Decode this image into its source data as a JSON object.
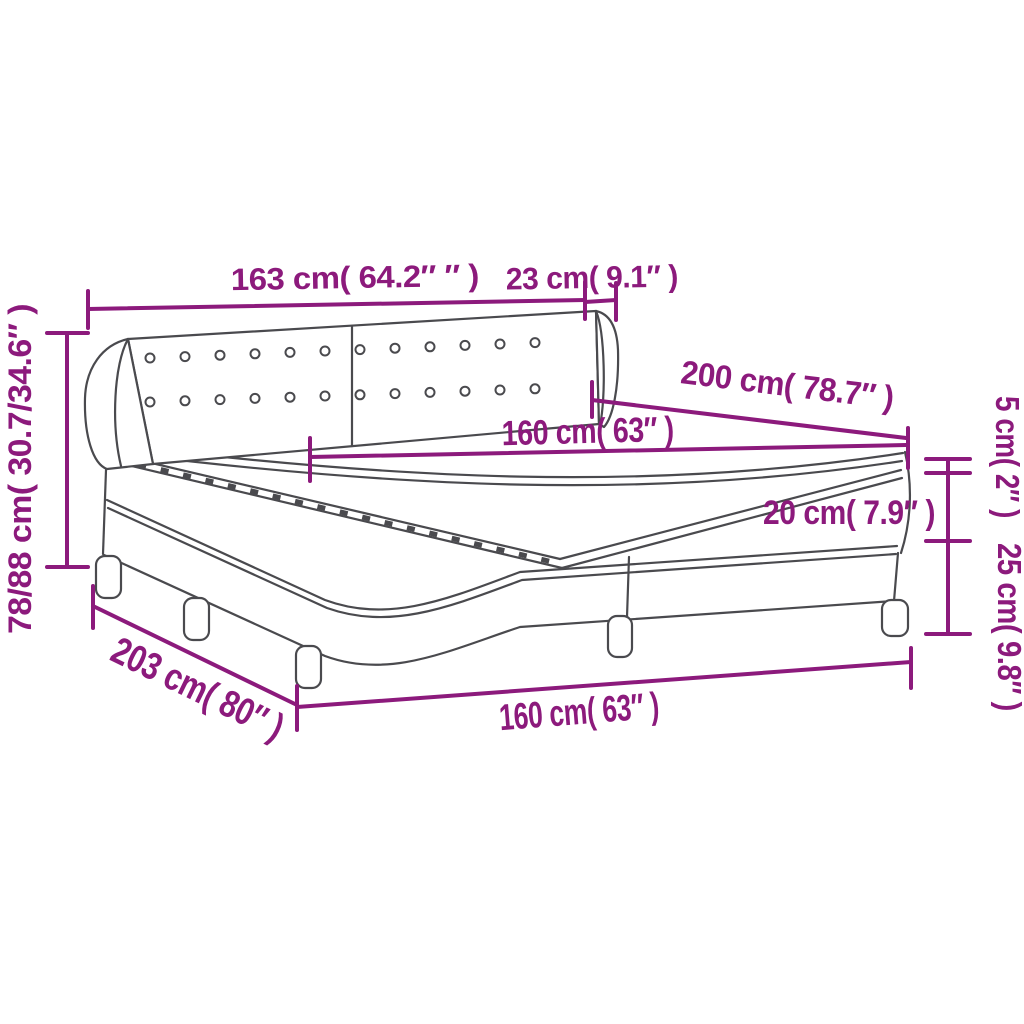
{
  "diagram": {
    "subject": "box-spring-bed-with-headboard",
    "colors": {
      "dimension": "#8C1A7C",
      "line_art": "#4a4a4e",
      "background": "#ffffff"
    },
    "dimensions": {
      "headboard_width": "163 cm( 64.2″ ″ )",
      "wing_depth": "23 cm( 9.1″ )",
      "bed_length": "200 cm( 78.7″ )",
      "mattress_width": "160 cm( 63″ )",
      "topper_height": "5 cm( 2″ )",
      "mattress_height": "20 cm( 7.9″ )",
      "base_height": "25 cm( 9.8″ )",
      "total_height": "78/88 cm( 30.7/34.6″ )",
      "total_length": "203 cm( 80″ )",
      "base_width": "160 cm( 63″ )"
    },
    "button_count": 24
  }
}
